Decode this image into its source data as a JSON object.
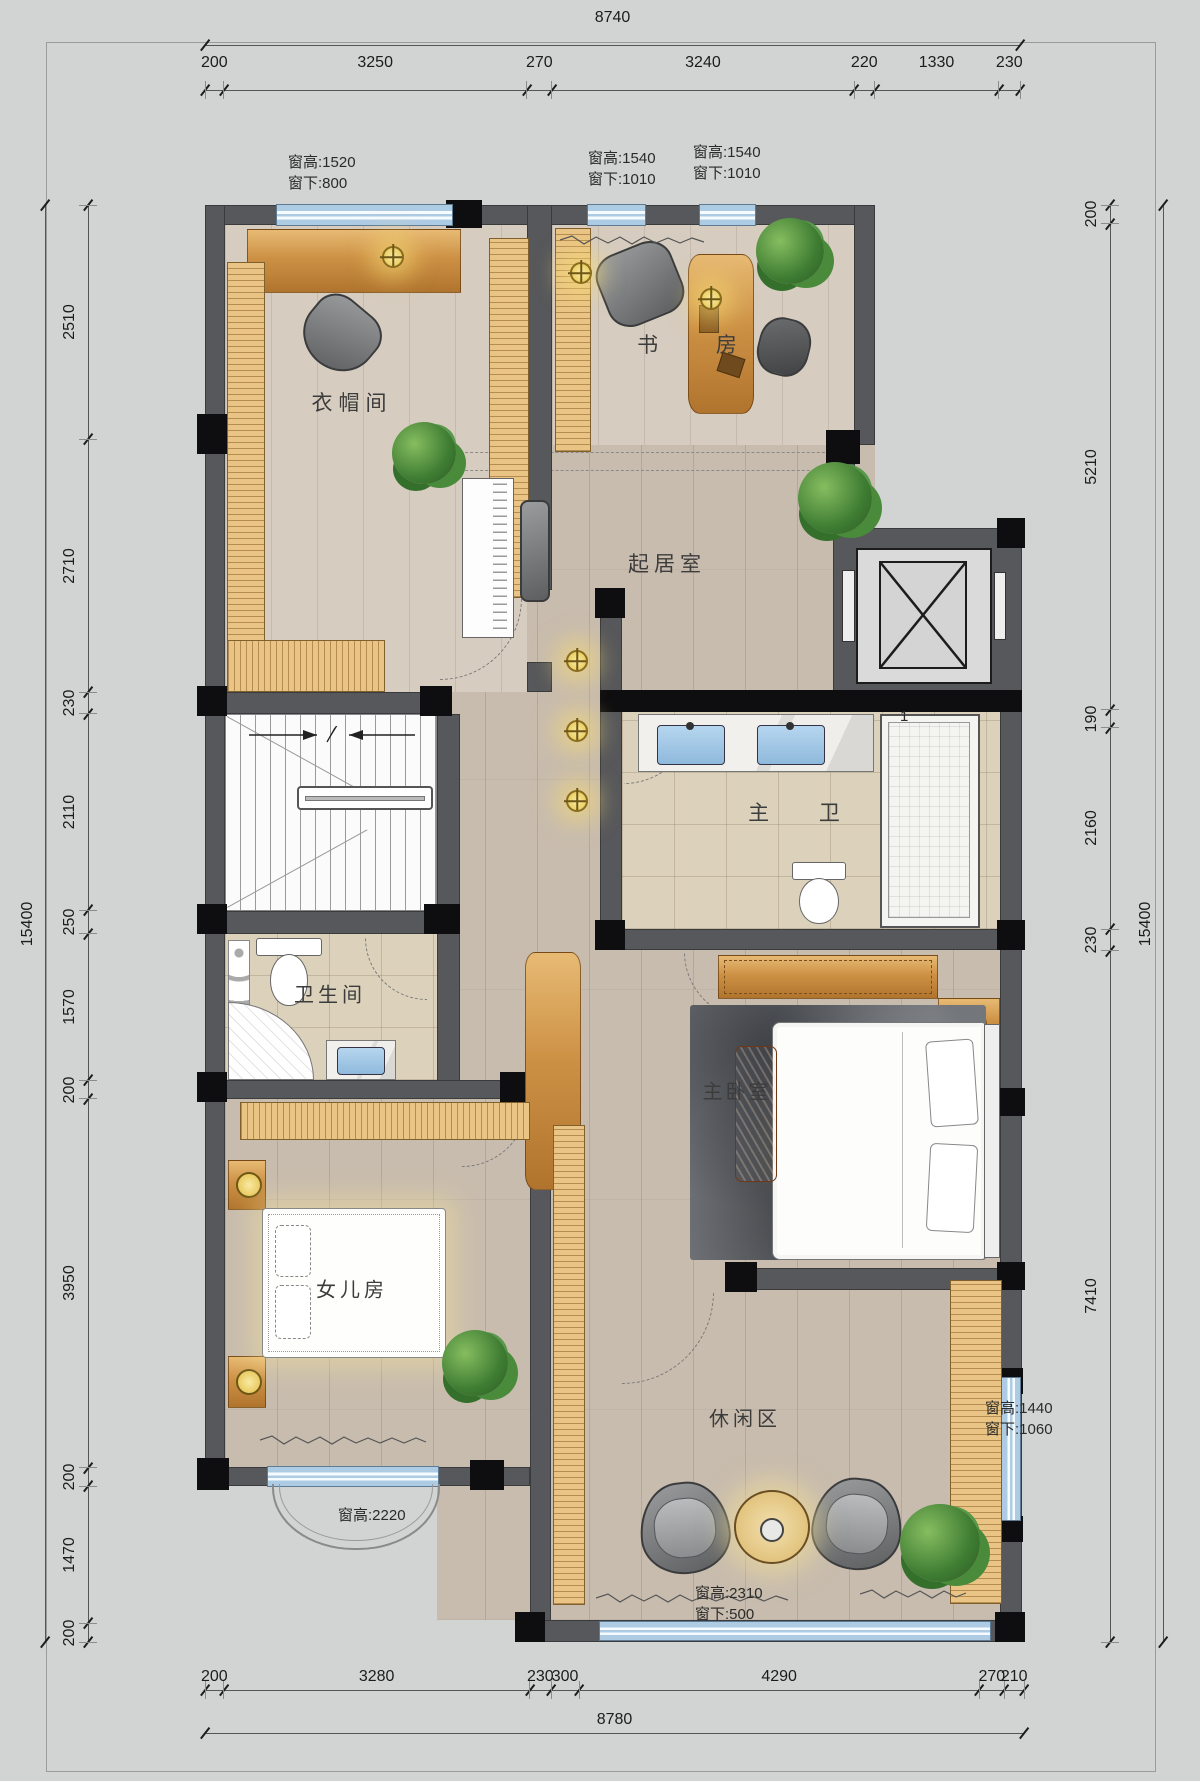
{
  "labels": {
    "cloakroom": "衣帽间",
    "study": "书 房",
    "living": "起居室",
    "master_bath": "主 卫",
    "bathroom": "卫生间",
    "master_bedroom": "主卧室",
    "daughter_room": "女儿房",
    "leisure": "休闲区",
    "elevator_tag": "1"
  },
  "window_annotations": [
    {
      "id": "closet-top",
      "lines": [
        "窗高:1520",
        "窗下:800"
      ]
    },
    {
      "id": "study-win-1",
      "lines": [
        "窗高:1540",
        "窗下:1010"
      ]
    },
    {
      "id": "study-win-2",
      "lines": [
        "窗高:1540",
        "窗下:1010"
      ]
    },
    {
      "id": "daughter-bay",
      "lines": [
        "窗高:2220"
      ]
    },
    {
      "id": "leisure-bottom",
      "lines": [
        "窗高:2310",
        "窗下:500"
      ]
    },
    {
      "id": "leisure-right",
      "lines": [
        "窗高:1440",
        "窗下:1060"
      ]
    }
  ],
  "dimensions": {
    "top": {
      "overall": "8740",
      "segments": [
        200,
        3250,
        270,
        3240,
        220,
        1330,
        230
      ]
    },
    "bottom": {
      "overall": "8780",
      "segments": [
        200,
        3280,
        230,
        300,
        4290,
        270,
        210
      ]
    },
    "left": {
      "overall": "15400",
      "segments": [
        2510,
        2710,
        230,
        2110,
        250,
        1570,
        200,
        3950,
        200,
        1470,
        200
      ]
    },
    "right": {
      "overall": "15400",
      "segments": [
        200,
        5210,
        190,
        2160,
        230,
        7410
      ]
    }
  },
  "colors": {
    "wall": "#57585b",
    "window": "#aecbe4",
    "accent_wood": "#cd9145",
    "page": "#d2d3d3"
  }
}
